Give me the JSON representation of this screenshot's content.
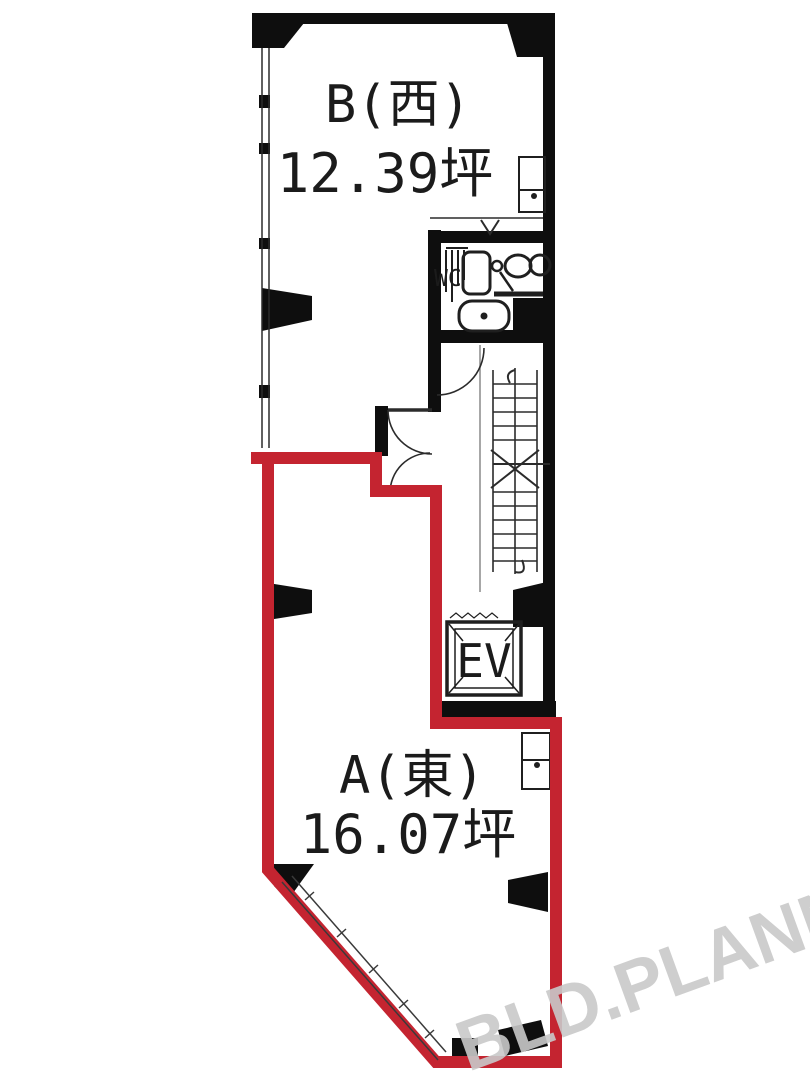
{
  "floorplan": {
    "units": [
      {
        "name": "B(西)",
        "area": "12.39坪"
      },
      {
        "name": "A(東)",
        "area": "16.07坪"
      }
    ],
    "wc_label": "WC",
    "ev_label": "EV",
    "watermark": "BLD.PLANNER",
    "colors": {
      "wall": "#0e0e0e",
      "unit_a_outline": "#c42430",
      "fixture_line": "#1f1f1f",
      "watermark_gray": "#c9c9c9"
    }
  }
}
